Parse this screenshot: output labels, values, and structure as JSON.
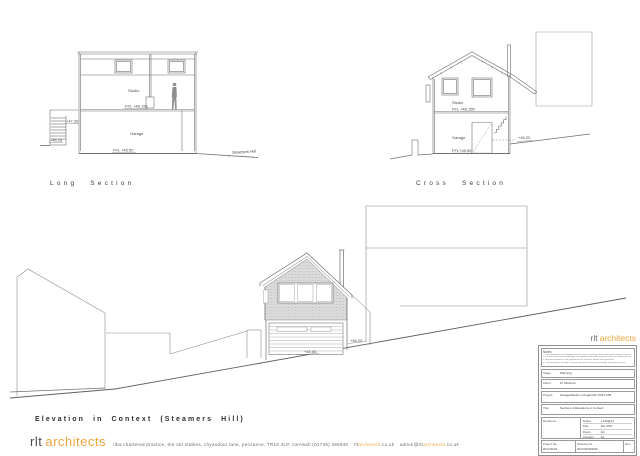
{
  "colors": {
    "accent": "#eda63a",
    "line": "#8a8a8a"
  },
  "long_section": {
    "title": "Long Section",
    "studio": "Studio",
    "garage": "Garage",
    "ffl_studio": "FFL +48.155",
    "ffl_garage": "FFL +45.50",
    "level_entry": "+47.30",
    "level_path": "+46.28",
    "road": "Steamers Hill"
  },
  "cross_section": {
    "title": "Cross Section",
    "studio": "Studio",
    "ffl_studio": "FFL +48.155",
    "garage": "Garage",
    "ffl_garage": "FFL+45.50",
    "level_rear": "+46.20"
  },
  "elevation": {
    "title": "Elevation in Context (Steamers Hill)",
    "level_garage": "+45.50",
    "level_ground": "+46.20"
  },
  "footer": {
    "logo_rlt": "rlt",
    "logo_architects": "architects",
    "contact": "riba chartered practice,  the old stables,  chyandour lane,  penzance,  TR18 3LP,  cornwall   (01736) 365946",
    "web_prefix": "rlt",
    "web_highlight": "architects",
    "web_suffix": ".co.uk",
    "email_prefix": "admin@rlt",
    "email_highlight": "architects",
    "email_suffix": ".co.uk"
  },
  "title_block": {
    "logo_rlt": "rlt",
    "logo_architects": "architects",
    "notes_label": "Notes:",
    "notes": [
      "1. This drawing is the copyright of the architect and may not be reproduced without licence.",
      "2. Do not scale from this drawing; use figured dimensions only and check all dimensions on site.",
      "3. Any discrepancies to be reported to the architect before work proceeds.",
      "4. This drawing to be read in conjunction with all relevant drawings and specifications."
    ],
    "stage_label": "Stage:",
    "stage": "Planning",
    "client_label": "Client:",
    "client": "M. McGuire",
    "project_label": "Project:",
    "project": "Garage/Studio in Angarrack TR27 5JB",
    "title_label": "Title:",
    "title": "Sections & Elevations in Context",
    "revisions_label": "Revisions",
    "revisions": [
      "-",
      "-",
      "-"
    ],
    "scales_label": "Scales",
    "scales": "1:100@A1",
    "date_label": "Date",
    "date": "Dec 2017",
    "drawn_label": "Drawn",
    "drawn": "AG",
    "checked_label": "Checked",
    "checked": "DL",
    "project_no_label": "Project No.",
    "project_no": "2017/2043",
    "drawing_no_label": "Drawing No.",
    "drawing_no": "2017/2043/D06",
    "rev_label": "Rev."
  }
}
